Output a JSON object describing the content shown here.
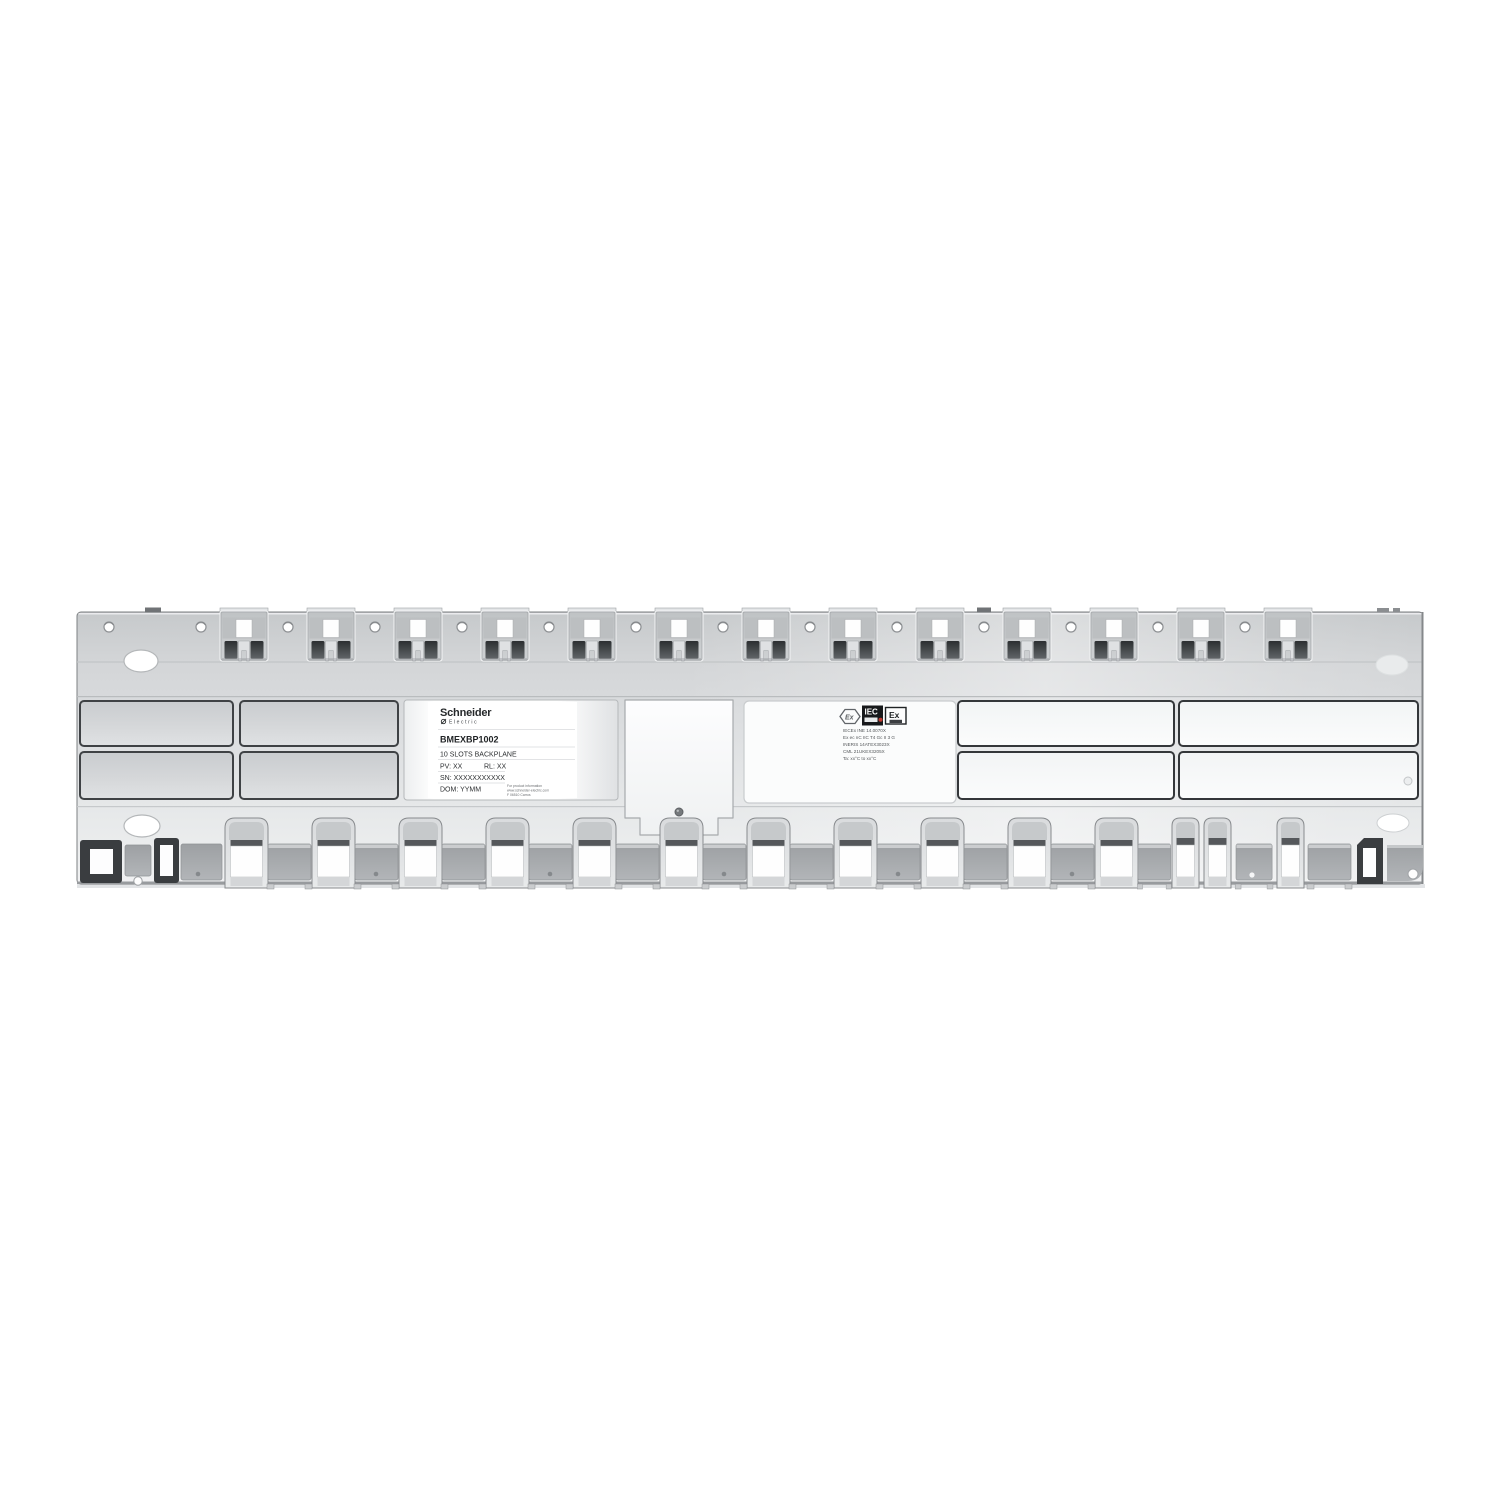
{
  "label": {
    "brand": "Schneider",
    "brand_sub": "Electric",
    "model": "BMEXBP1002",
    "description": "10 SLOTS BACKPLANE",
    "pv": "PV: XX",
    "rl": "RL: XX",
    "sn": "SN: XXXXXXXXXXX",
    "dom": "DOM: YYMM",
    "info": [
      "For product information",
      "www.schneider-electric.com",
      "F 06510 Carros"
    ]
  },
  "cert": {
    "hex_mark": "Ex",
    "iec_mark": "IEC",
    "ex_mark": "Ex",
    "lines": [
      "IECEx INE 14.0070X",
      "Ex ec nC IIC T4 Gc II 3 G",
      "INERIS 14ATEX3023X",
      "CML 21UKEX3205X",
      "Ta: xx°C to xx°C"
    ]
  },
  "colors": {
    "background": "#ffffff",
    "plate": "#d8dadc",
    "plate_dark": "#c8cbcd",
    "recess_outline": "#3f4245",
    "hole_dark": "#2e3133",
    "label_white": "#ffffff"
  }
}
